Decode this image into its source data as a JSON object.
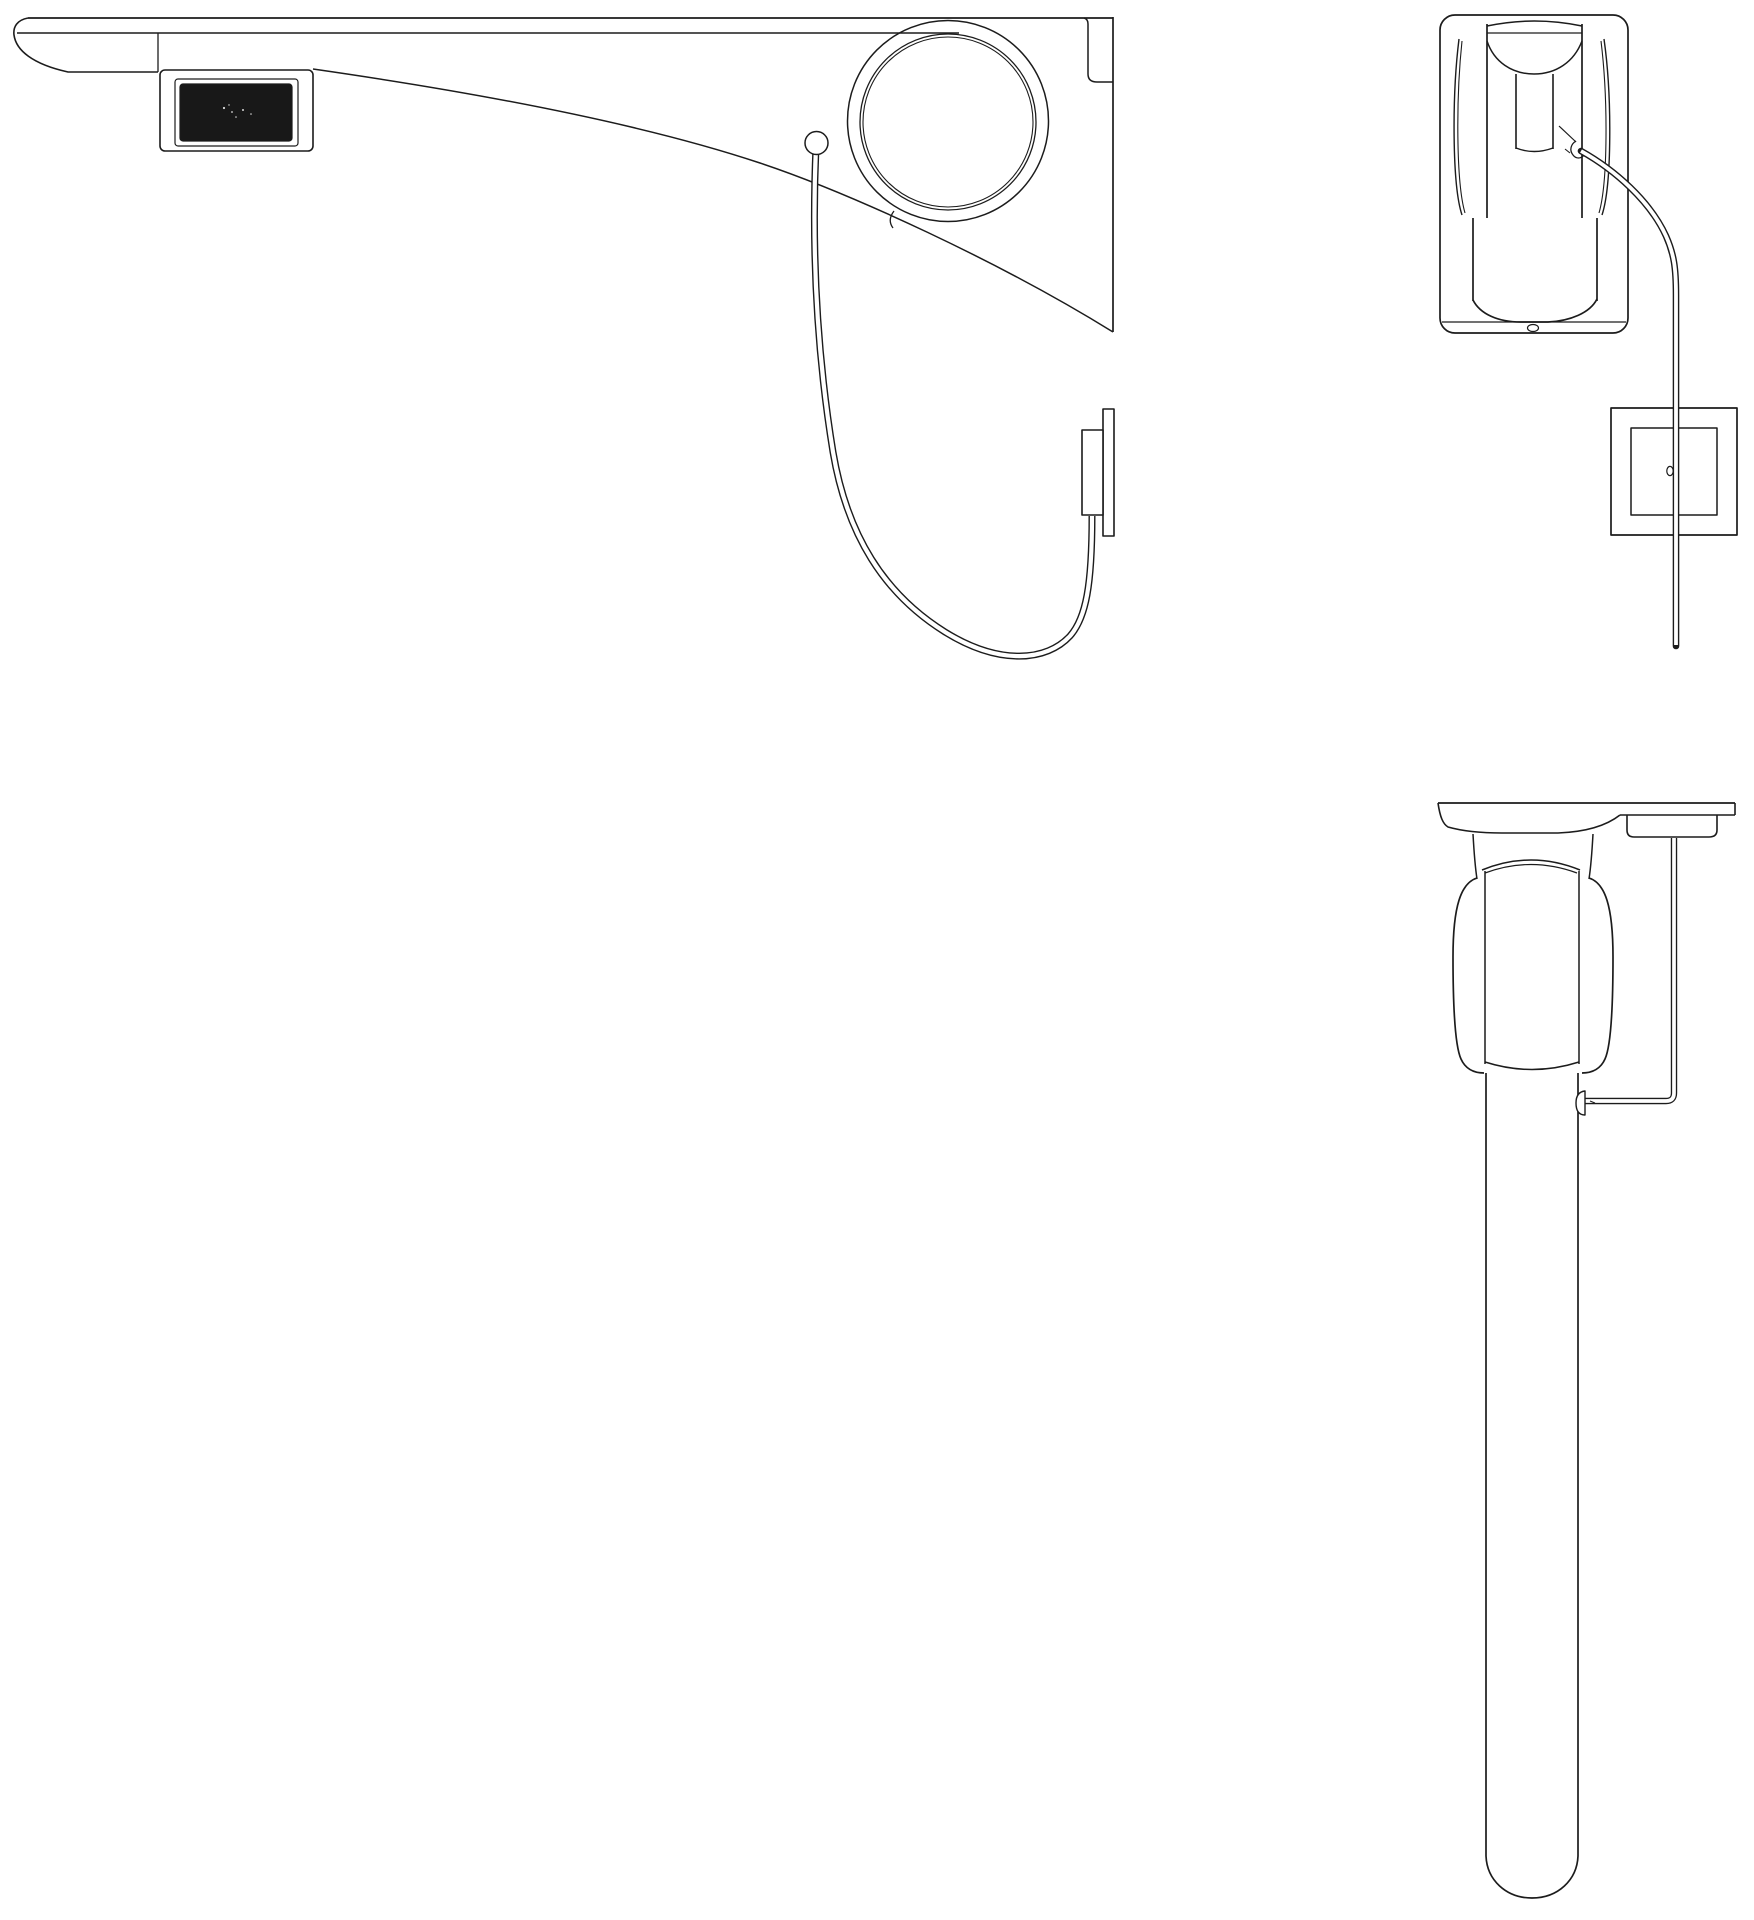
{
  "document": {
    "type": "technical-line-drawing",
    "subject": "wall-mounted sensor faucet, three orthographic views",
    "visible_text": ""
  },
  "colors": {
    "background": "#ffffff",
    "line": "#1c1c1c",
    "sensor_window_fill": "#181818",
    "speck": "#d9d9d9"
  },
  "views": [
    {
      "id": "side-view",
      "position": "top-left",
      "parts": [
        "spout",
        "sensor-window",
        "mounting-ring",
        "wall-plate-edge",
        "cable-grommet",
        "sensor-cable",
        "control-box"
      ]
    },
    {
      "id": "front-view",
      "position": "top-right",
      "parts": [
        "wall-plate",
        "body-barrel",
        "spout-tube",
        "cable-hook",
        "sensor-cable",
        "control-box",
        "drain-hole"
      ]
    },
    {
      "id": "top-view",
      "position": "bottom-right",
      "parts": [
        "wall-line",
        "escutcheon",
        "neck",
        "body-barrel",
        "spout-tube",
        "sensor-cable",
        "cable-connector",
        "control-box"
      ]
    }
  ]
}
